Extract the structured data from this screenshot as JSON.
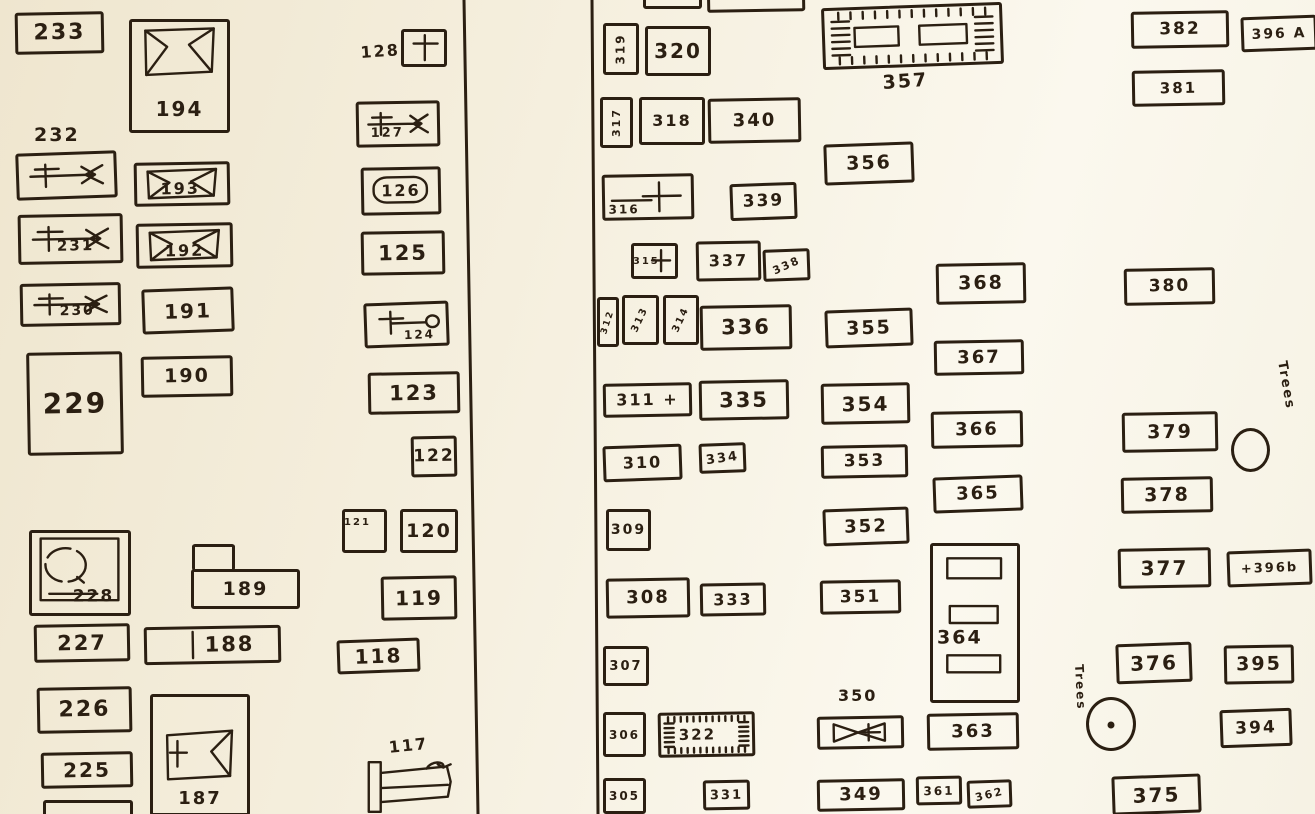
{
  "canvas": {
    "width": 1315,
    "height": 814,
    "paper_color": "#f5efde",
    "ink_color": "#2b1f12"
  },
  "dividers": [
    {
      "x1": 464,
      "y1": 0,
      "x2": 478,
      "y2": 814
    },
    {
      "x1": 592,
      "y1": 0,
      "x2": 598,
      "y2": 814
    }
  ],
  "plots": [
    {
      "id": "233",
      "label": "233",
      "x": 15,
      "y": 12,
      "w": 89,
      "h": 42,
      "fs": 22,
      "r": -1
    },
    {
      "id": "194",
      "label": "194",
      "x": 129,
      "y": 19,
      "w": 101,
      "h": 114,
      "fs": 20,
      "r": 0,
      "sketch": "casketTop",
      "px": 50,
      "py": 81
    },
    {
      "id": "232",
      "x": 16,
      "y": 152,
      "w": 101,
      "h": 47,
      "r": -2,
      "sketch": "crossbar"
    },
    {
      "id": "193",
      "label": "193",
      "x": 134,
      "y": 162,
      "w": 96,
      "h": 44,
      "fs": 16,
      "r": -1,
      "sketch": "casketFull",
      "px": 48,
      "py": 62
    },
    {
      "id": "231",
      "label": "231",
      "x": 18,
      "y": 214,
      "w": 105,
      "h": 50,
      "fs": 15,
      "r": -1,
      "sketch": "crossbar",
      "px": 55,
      "py": 66
    },
    {
      "id": "192",
      "label": "192",
      "x": 136,
      "y": 223,
      "w": 97,
      "h": 45,
      "fs": 16,
      "r": -1,
      "sketch": "casketFull",
      "px": 50,
      "py": 64
    },
    {
      "id": "230",
      "label": "230",
      "x": 20,
      "y": 283,
      "w": 101,
      "h": 43,
      "fs": 14,
      "r": -1,
      "sketch": "crossbar",
      "px": 57,
      "py": 68
    },
    {
      "id": "191",
      "label": "191",
      "x": 142,
      "y": 288,
      "w": 92,
      "h": 45,
      "fs": 20,
      "r": -2
    },
    {
      "id": "229",
      "label": "229",
      "x": 27,
      "y": 352,
      "w": 96,
      "h": 103,
      "fs": 28,
      "r": -1
    },
    {
      "id": "190",
      "label": "190",
      "x": 141,
      "y": 356,
      "w": 92,
      "h": 41,
      "fs": 19,
      "r": -1
    },
    {
      "id": "228",
      "label": "228",
      "x": 29,
      "y": 530,
      "w": 102,
      "h": 86,
      "fs": 17,
      "r": 0,
      "sketch": "circlesq",
      "px": 64,
      "py": 80
    },
    {
      "id": "189",
      "label": "189",
      "x": 191,
      "y": 569,
      "w": 109,
      "h": 40,
      "fs": 19,
      "r": 0
    },
    {
      "id": "189-annex",
      "x": 192,
      "y": 544,
      "w": 43,
      "h": 27,
      "open": "bottom",
      "r": 0
    },
    {
      "id": "227",
      "label": "227",
      "x": 34,
      "y": 624,
      "w": 96,
      "h": 38,
      "fs": 21,
      "r": -1
    },
    {
      "id": "188",
      "label": "188",
      "x": 144,
      "y": 626,
      "w": 137,
      "h": 38,
      "fs": 21,
      "r": -1,
      "sketch": "vline",
      "px": 63,
      "py": 50
    },
    {
      "id": "226",
      "label": "226",
      "x": 37,
      "y": 687,
      "w": 95,
      "h": 46,
      "fs": 22,
      "r": -1
    },
    {
      "id": "225",
      "label": "225",
      "x": 41,
      "y": 752,
      "w": 92,
      "h": 36,
      "fs": 20,
      "r": -1
    },
    {
      "id": "187",
      "label": "187",
      "x": 150,
      "y": 694,
      "w": 100,
      "h": 122,
      "fs": 18,
      "r": 0,
      "sketch": "casketMid",
      "px": 50,
      "py": 88
    },
    {
      "id": "224-partial",
      "x": 43,
      "y": 800,
      "w": 90,
      "h": 30,
      "r": 0
    },
    {
      "id": "128",
      "x": 401,
      "y": 29,
      "w": 46,
      "h": 38,
      "r": 0,
      "sketch": "tcross"
    },
    {
      "id": "127",
      "label": "127",
      "x": 356,
      "y": 101,
      "w": 84,
      "h": 46,
      "fs": 13,
      "r": -1,
      "sketch": "crossbar",
      "px": 36,
      "py": 73
    },
    {
      "id": "126",
      "label": "126",
      "x": 361,
      "y": 167,
      "w": 80,
      "h": 48,
      "fs": 16,
      "r": -1,
      "sketch": "rounded"
    },
    {
      "id": "125",
      "label": "125",
      "x": 361,
      "y": 231,
      "w": 84,
      "h": 44,
      "fs": 21,
      "r": -1
    },
    {
      "id": "124",
      "label": "124",
      "x": 364,
      "y": 302,
      "w": 85,
      "h": 45,
      "fs": 12,
      "r": -2,
      "sketch": "crossoval",
      "px": 66,
      "py": 77
    },
    {
      "id": "123",
      "label": "123",
      "x": 368,
      "y": 372,
      "w": 92,
      "h": 42,
      "fs": 21,
      "r": -1
    },
    {
      "id": "122",
      "label": "122",
      "x": 411,
      "y": 436,
      "w": 46,
      "h": 41,
      "fs": 17,
      "r": -1
    },
    {
      "id": "121",
      "label": "121",
      "x": 342,
      "y": 509,
      "w": 45,
      "h": 44,
      "fs": 10,
      "r": 0,
      "px": 32,
      "py": 28
    },
    {
      "id": "120",
      "label": "120",
      "x": 400,
      "y": 509,
      "w": 58,
      "h": 44,
      "fs": 19,
      "r": 0
    },
    {
      "id": "119",
      "label": "119",
      "x": 381,
      "y": 576,
      "w": 76,
      "h": 44,
      "fs": 20,
      "r": -1
    },
    {
      "id": "118",
      "label": "118",
      "x": 337,
      "y": 639,
      "w": 83,
      "h": 34,
      "fs": 20,
      "r": -2
    },
    {
      "id": "117",
      "x": 366,
      "y": 760,
      "w": 92,
      "h": 54,
      "r": 0,
      "sketch": "bed",
      "noborder": true
    },
    {
      "id": "top-partial-a",
      "x": 643,
      "y": -24,
      "w": 59,
      "h": 33,
      "r": 0
    },
    {
      "id": "top-partial-b",
      "x": 707,
      "y": -22,
      "w": 98,
      "h": 34,
      "r": -1
    },
    {
      "id": "319",
      "label": "319",
      "x": 603,
      "y": 23,
      "w": 36,
      "h": 52,
      "fs": 12,
      "r": 0,
      "rot": -90
    },
    {
      "id": "320",
      "label": "320",
      "x": 645,
      "y": 26,
      "w": 66,
      "h": 50,
      "fs": 20,
      "r": 0
    },
    {
      "id": "317",
      "label": "317",
      "x": 600,
      "y": 97,
      "w": 33,
      "h": 51,
      "fs": 11,
      "r": 0,
      "rot": -90
    },
    {
      "id": "318",
      "label": "318",
      "x": 639,
      "y": 97,
      "w": 66,
      "h": 48,
      "fs": 16,
      "r": 0
    },
    {
      "id": "340",
      "label": "340",
      "x": 708,
      "y": 98,
      "w": 93,
      "h": 45,
      "fs": 18,
      "r": -1
    },
    {
      "id": "316",
      "label": "316",
      "x": 602,
      "y": 174,
      "w": 92,
      "h": 46,
      "fs": 12,
      "r": -1,
      "sketch": "barplus",
      "px": 22,
      "py": 80
    },
    {
      "id": "339",
      "label": "339",
      "x": 730,
      "y": 183,
      "w": 67,
      "h": 37,
      "fs": 17,
      "r": -2
    },
    {
      "id": "315",
      "label": "315",
      "x": 631,
      "y": 243,
      "w": 47,
      "h": 36,
      "fs": 10,
      "r": 0,
      "sketch": "plusr",
      "px": 30,
      "py": 52
    },
    {
      "id": "337",
      "label": "337",
      "x": 696,
      "y": 241,
      "w": 65,
      "h": 40,
      "fs": 16,
      "r": -1
    },
    {
      "id": "338",
      "label": "338",
      "x": 763,
      "y": 249,
      "w": 47,
      "h": 32,
      "fs": 11,
      "r": -2,
      "rot": -22
    },
    {
      "id": "312",
      "label": "312",
      "x": 597,
      "y": 297,
      "w": 22,
      "h": 50,
      "fs": 9,
      "r": 0,
      "rot": -72
    },
    {
      "id": "313",
      "label": "313",
      "x": 622,
      "y": 295,
      "w": 37,
      "h": 50,
      "fs": 10,
      "r": 0,
      "rot": -65
    },
    {
      "id": "314",
      "label": "314",
      "x": 663,
      "y": 295,
      "w": 36,
      "h": 50,
      "fs": 10,
      "r": 0,
      "rot": -65
    },
    {
      "id": "336",
      "label": "336",
      "x": 700,
      "y": 305,
      "w": 92,
      "h": 45,
      "fs": 21,
      "r": -1
    },
    {
      "id": "355",
      "label": "355",
      "x": 825,
      "y": 309,
      "w": 88,
      "h": 38,
      "fs": 19,
      "r": -2
    },
    {
      "id": "311",
      "label": "311 +",
      "x": 603,
      "y": 383,
      "w": 89,
      "h": 34,
      "fs": 16,
      "r": -1
    },
    {
      "id": "335",
      "label": "335",
      "x": 699,
      "y": 380,
      "w": 90,
      "h": 40,
      "fs": 21,
      "r": -1
    },
    {
      "id": "354",
      "label": "354",
      "x": 821,
      "y": 383,
      "w": 89,
      "h": 41,
      "fs": 20,
      "r": -1
    },
    {
      "id": "310",
      "label": "310",
      "x": 603,
      "y": 445,
      "w": 79,
      "h": 36,
      "fs": 16,
      "r": -2
    },
    {
      "id": "334",
      "label": "334",
      "x": 699,
      "y": 443,
      "w": 47,
      "h": 30,
      "fs": 13,
      "r": -2,
      "rot": -6
    },
    {
      "id": "353",
      "label": "353",
      "x": 821,
      "y": 445,
      "w": 87,
      "h": 33,
      "fs": 17,
      "r": -1
    },
    {
      "id": "309",
      "label": "309",
      "x": 606,
      "y": 509,
      "w": 45,
      "h": 42,
      "fs": 14,
      "r": 0
    },
    {
      "id": "352",
      "label": "352",
      "x": 823,
      "y": 508,
      "w": 86,
      "h": 37,
      "fs": 18,
      "r": -2
    },
    {
      "id": "308",
      "label": "308",
      "x": 606,
      "y": 578,
      "w": 84,
      "h": 40,
      "fs": 18,
      "r": -1
    },
    {
      "id": "333",
      "label": "333",
      "x": 700,
      "y": 583,
      "w": 66,
      "h": 33,
      "fs": 16,
      "r": -1
    },
    {
      "id": "351",
      "label": "351",
      "x": 820,
      "y": 580,
      "w": 81,
      "h": 34,
      "fs": 17,
      "r": -1
    },
    {
      "id": "307",
      "label": "307",
      "x": 603,
      "y": 646,
      "w": 46,
      "h": 40,
      "fs": 13,
      "r": 0
    },
    {
      "id": "306",
      "label": "306",
      "x": 603,
      "y": 712,
      "w": 43,
      "h": 45,
      "fs": 12,
      "r": 0
    },
    {
      "id": "322",
      "label": "322",
      "x": 658,
      "y": 712,
      "w": 97,
      "h": 45,
      "fs": 15,
      "r": -1,
      "sketch": "hatch",
      "px": 40,
      "py": 52
    },
    {
      "id": "350",
      "x": 817,
      "y": 716,
      "w": 87,
      "h": 33,
      "r": -1,
      "sketch": "bowtie"
    },
    {
      "id": "363",
      "label": "363",
      "x": 927,
      "y": 713,
      "w": 92,
      "h": 37,
      "fs": 18,
      "r": -1
    },
    {
      "id": "305",
      "label": "305",
      "x": 603,
      "y": 778,
      "w": 43,
      "h": 36,
      "fs": 12,
      "r": 0
    },
    {
      "id": "331",
      "label": "331",
      "x": 703,
      "y": 780,
      "w": 47,
      "h": 30,
      "fs": 13,
      "r": -1
    },
    {
      "id": "349",
      "label": "349",
      "x": 817,
      "y": 779,
      "w": 88,
      "h": 32,
      "fs": 18,
      "r": -1
    },
    {
      "id": "361",
      "label": "361",
      "x": 916,
      "y": 776,
      "w": 46,
      "h": 29,
      "fs": 12,
      "r": -1
    },
    {
      "id": "362",
      "label": "362",
      "x": 967,
      "y": 780,
      "w": 45,
      "h": 28,
      "fs": 11,
      "r": -2,
      "rot": -12
    },
    {
      "id": "357",
      "x": 822,
      "y": 5,
      "w": 181,
      "h": 62,
      "r": -2,
      "sketch": "hatch2"
    },
    {
      "id": "356",
      "label": "356",
      "x": 824,
      "y": 143,
      "w": 90,
      "h": 41,
      "fs": 19,
      "r": -2
    },
    {
      "id": "368",
      "label": "368",
      "x": 936,
      "y": 263,
      "w": 90,
      "h": 41,
      "fs": 19,
      "r": -1
    },
    {
      "id": "367",
      "label": "367",
      "x": 934,
      "y": 340,
      "w": 90,
      "h": 35,
      "fs": 18,
      "r": -1
    },
    {
      "id": "366",
      "label": "366",
      "x": 931,
      "y": 411,
      "w": 92,
      "h": 37,
      "fs": 18,
      "r": -1
    },
    {
      "id": "365",
      "label": "365",
      "x": 933,
      "y": 476,
      "w": 90,
      "h": 36,
      "fs": 18,
      "r": -2
    },
    {
      "id": "364",
      "label": "364",
      "x": 930,
      "y": 543,
      "w": 90,
      "h": 160,
      "fs": 19,
      "r": 0,
      "sketch": "threerects",
      "px": 32,
      "py": 60
    },
    {
      "id": "382",
      "label": "382",
      "x": 1131,
      "y": 11,
      "w": 98,
      "h": 37,
      "fs": 17,
      "r": -1
    },
    {
      "id": "396A",
      "label": "396 A",
      "x": 1241,
      "y": 16,
      "w": 76,
      "h": 35,
      "fs": 14,
      "r": -2
    },
    {
      "id": "381",
      "label": "381",
      "x": 1132,
      "y": 70,
      "w": 93,
      "h": 36,
      "fs": 15,
      "r": -1
    },
    {
      "id": "380",
      "label": "380",
      "x": 1124,
      "y": 268,
      "w": 91,
      "h": 37,
      "fs": 17,
      "r": -1
    },
    {
      "id": "379",
      "label": "379",
      "x": 1122,
      "y": 412,
      "w": 96,
      "h": 40,
      "fs": 19,
      "r": -1
    },
    {
      "id": "378",
      "label": "378",
      "x": 1121,
      "y": 477,
      "w": 92,
      "h": 36,
      "fs": 19,
      "r": -1
    },
    {
      "id": "377",
      "label": "377",
      "x": 1118,
      "y": 548,
      "w": 93,
      "h": 40,
      "fs": 20,
      "r": -1
    },
    {
      "id": "396b",
      "label": "+396b",
      "x": 1227,
      "y": 550,
      "w": 85,
      "h": 36,
      "fs": 13,
      "r": -2
    },
    {
      "id": "376",
      "label": "376",
      "x": 1116,
      "y": 643,
      "w": 76,
      "h": 40,
      "fs": 20,
      "r": -2
    },
    {
      "id": "395",
      "label": "395",
      "x": 1224,
      "y": 645,
      "w": 70,
      "h": 39,
      "fs": 19,
      "r": -1
    },
    {
      "id": "394",
      "label": "394",
      "x": 1220,
      "y": 709,
      "w": 72,
      "h": 38,
      "fs": 17,
      "r": -2
    },
    {
      "id": "375",
      "label": "375",
      "x": 1112,
      "y": 775,
      "w": 89,
      "h": 39,
      "fs": 20,
      "r": -2
    }
  ],
  "labels": [
    {
      "id": "232-caption",
      "text": "232",
      "x": 34,
      "y": 126,
      "fs": 19,
      "rot": 0
    },
    {
      "id": "128-caption",
      "text": "128",
      "x": 360,
      "y": 45,
      "fs": 16,
      "rot": -4
    },
    {
      "id": "117-caption",
      "text": "117",
      "x": 388,
      "y": 740,
      "fs": 16,
      "rot": -6
    },
    {
      "id": "357-caption",
      "text": "357",
      "x": 882,
      "y": 74,
      "fs": 19,
      "rot": -4
    },
    {
      "id": "350-caption",
      "text": "350",
      "x": 838,
      "y": 688,
      "fs": 16,
      "rot": 0
    },
    {
      "id": "trees-1",
      "text": "Trees",
      "x": 1288,
      "y": 360,
      "fs": 13,
      "rot": 80
    },
    {
      "id": "trees-2",
      "text": "Trees",
      "x": 1085,
      "y": 664,
      "fs": 12,
      "rot": 87
    }
  ],
  "shapes": [
    {
      "id": "tree-1",
      "type": "circle",
      "x": 1231,
      "y": 428,
      "w": 39,
      "h": 44,
      "dot": false
    },
    {
      "id": "tree-2",
      "type": "circle",
      "x": 1086,
      "y": 697,
      "w": 50,
      "h": 54,
      "dot": true
    }
  ]
}
